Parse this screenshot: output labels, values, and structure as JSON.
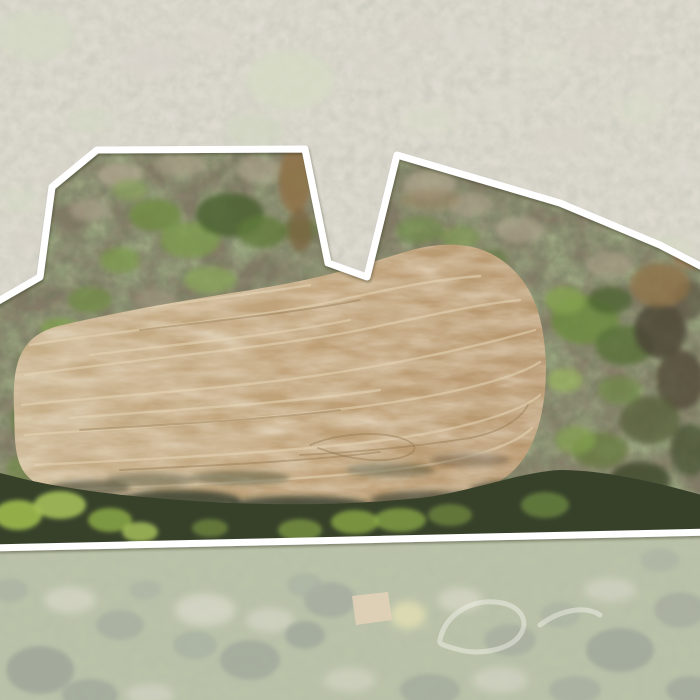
{
  "image": {
    "kind": "aerial-drone-property-photo",
    "description": "Overhead drone photo of a rural parcel outlined with a thick white surveyed boundary. Inside the boundary: leaf-off hardwood forest with scattered green canopy on the upper slope, a large tan tilled crop field with curved cultivation striations in the center, and a dark shadowed tree line along the southern edge. Everything outside the boundary is washed out by a translucent white mask: pale woodland and clearings above, a mowed park-like lawn with scattered trees below."
  },
  "boundary": {
    "stroke_color": "#ffffff",
    "stroke_width": 7,
    "fade_color": "#ffffff",
    "fade_opacity": 0.47,
    "points": "-12,307 40,277 52,187 97,150 305,149 328,263 367,277 397,155 560,203 660,245 712,272 712,532 -12,548"
  },
  "field": {
    "base_color_left": "#c9b28c",
    "base_color_right": "#b6946a",
    "striation_color": "#e6d5b6",
    "track_color": "#93774f",
    "path": "M14,408 C12,360 22,336 58,326 C118,312 185,300 245,291 C288,284 322,277 352,268 C372,262 385,258 405,252 C425,246 440,244 458,245 C478,246 500,254 519,276 C537,297 545,327 546,367 C546,408 537,449 512,472 C483,498 432,503 372,507 C300,513 220,514 152,509 C92,505 42,496 24,472 C13,456 15,430 14,408 Z",
    "striations": [
      "M45,320 C130,308 230,298 310,285",
      "M30,345 C120,330 260,318 340,300 C390,289 430,280 480,276",
      "M25,375 C130,360 250,350 350,332 C420,318 470,305 520,300",
      "M22,405 C120,395 240,388 340,372 C430,358 500,340 535,330",
      "M25,435 C120,428 240,422 350,408 C450,396 515,378 540,362",
      "M35,465 C130,460 250,455 360,443 C460,432 520,412 540,395",
      "M60,490 C160,486 280,482 390,470 C470,461 515,445 532,428",
      "M90,355 C180,344 270,336 350,320",
      "M70,418 C170,410 280,404 380,390"
    ],
    "tracks": [
      "M80,430 C160,425 260,420 340,410",
      "M300,455 C360,452 420,446 470,438 C500,432 520,420 528,405",
      "M310,445 C340,432 390,430 410,442 C425,452 400,462 370,460 C345,458 330,452 318,448",
      "M120,470 C200,466 300,462 380,452",
      "M140,330 C220,320 300,312 360,300"
    ]
  },
  "lawn": {
    "garden_patch_path": "M352,596 L388,592 L392,620 L356,625 Z",
    "garden_patch_color": "#c8a87a",
    "loop_paths": [
      "M440,640 C445,615 470,600 495,602 C520,604 530,620 520,635 C510,650 480,655 460,650 C445,646 438,644 440,640",
      "M540,625 C560,610 585,605 600,615"
    ],
    "loop_color": "#e2e4d4"
  },
  "palette": {
    "woods_base": "#867b68",
    "woods_green": "#7c9a4a",
    "woods_dark_green": "#3c4a2c",
    "bare_crown": "#b3a791",
    "tree_band": "#37412a",
    "band_lime": "#9db94e",
    "creek_brown": "#8f7148",
    "lawn": "#7e8e5c",
    "faded_top": "#c2baa8"
  },
  "scatter": {
    "upper_crowns_light": [
      [
        120,
        175,
        22,
        12,
        "#b3a791",
        0.7
      ],
      [
        180,
        165,
        26,
        12,
        "#aca08a",
        0.6
      ],
      [
        260,
        170,
        24,
        12,
        "#b3a791",
        0.6
      ],
      [
        330,
        190,
        20,
        12,
        "#a89c86",
        0.6
      ],
      [
        430,
        185,
        26,
        14,
        "#b3a791",
        0.65
      ],
      [
        470,
        205,
        22,
        12,
        "#aca08a",
        0.6
      ],
      [
        520,
        230,
        24,
        13,
        "#b3a791",
        0.6
      ],
      [
        610,
        265,
        24,
        13,
        "#a89c86",
        0.6
      ],
      [
        155,
        300,
        20,
        11,
        "#a89c86",
        0.5
      ],
      [
        430,
        270,
        18,
        10,
        "#b3a791",
        0.5
      ],
      [
        90,
        210,
        20,
        11,
        "#b3a791",
        0.55
      ],
      [
        360,
        230,
        18,
        10,
        "#aca08a",
        0.5
      ]
    ],
    "upper_woods_greens": [
      [
        155,
        215,
        26,
        16,
        "#6f8c42",
        0.8
      ],
      [
        190,
        240,
        30,
        18,
        "#7f9e4c",
        0.75
      ],
      [
        230,
        215,
        34,
        22,
        "#4e6333",
        0.85
      ],
      [
        262,
        232,
        24,
        16,
        "#617b3b",
        0.8
      ],
      [
        120,
        260,
        20,
        13,
        "#7c9a4a",
        0.7
      ],
      [
        210,
        280,
        26,
        14,
        "#88a655",
        0.65
      ],
      [
        90,
        300,
        22,
        13,
        "#6f8c42",
        0.7
      ],
      [
        60,
        330,
        20,
        12,
        "#7f9e4c",
        0.75
      ],
      [
        35,
        360,
        16,
        11,
        "#6f8c42",
        0.7
      ],
      [
        300,
        230,
        18,
        12,
        "#5d7539",
        0.6
      ],
      [
        330,
        300,
        22,
        13,
        "#55682f",
        0.8
      ],
      [
        370,
        300,
        20,
        12,
        "#64793b",
        0.7
      ],
      [
        420,
        230,
        24,
        14,
        "#6f8c42",
        0.55
      ],
      [
        460,
        238,
        20,
        12,
        "#7f9e4c",
        0.5
      ],
      [
        300,
        180,
        16,
        10,
        "#87a657",
        0.5
      ],
      [
        130,
        190,
        18,
        11,
        "#87a657",
        0.55
      ],
      [
        490,
        260,
        18,
        11,
        "#64793b",
        0.6
      ],
      [
        25,
        420,
        14,
        18,
        "#617b3b",
        0.65
      ],
      [
        20,
        470,
        14,
        14,
        "#6f8c42",
        0.6
      ]
    ],
    "right_woods": [
      [
        585,
        320,
        34,
        24,
        "#6d8a41",
        0.85
      ],
      [
        625,
        345,
        30,
        20,
        "#59713a",
        0.8
      ],
      [
        565,
        300,
        20,
        14,
        "#86a44f",
        0.8
      ],
      [
        610,
        300,
        22,
        14,
        "#4e6333",
        0.75
      ],
      [
        660,
        330,
        26,
        28,
        "#4a4434",
        0.8
      ],
      [
        680,
        380,
        24,
        30,
        "#514a38",
        0.8
      ],
      [
        650,
        420,
        30,
        24,
        "#55603a",
        0.75
      ],
      [
        600,
        450,
        28,
        18,
        "#64793b",
        0.7
      ],
      [
        575,
        440,
        20,
        14,
        "#86a44f",
        0.65
      ],
      [
        640,
        480,
        30,
        18,
        "#3f4a2c",
        0.8
      ],
      [
        690,
        450,
        20,
        26,
        "#455030",
        0.7
      ],
      [
        565,
        380,
        18,
        12,
        "#9ab558",
        0.6
      ],
      [
        690,
        300,
        16,
        20,
        "#5c5544",
        0.7
      ],
      [
        620,
        390,
        22,
        14,
        "#6d8a41",
        0.6
      ],
      [
        660,
        510,
        30,
        14,
        "#39432a",
        0.8
      ]
    ],
    "creek_patches": [
      [
        295,
        180,
        16,
        34,
        "#8f7148",
        0.85
      ],
      [
        300,
        230,
        12,
        22,
        "#7c633f",
        0.7
      ],
      [
        330,
        290,
        30,
        12,
        "#7c633f",
        0.8
      ],
      [
        660,
        285,
        30,
        22,
        "#8f7148",
        0.75
      ],
      [
        690,
        255,
        18,
        14,
        "#9b7b55",
        0.8
      ],
      [
        385,
        300,
        20,
        10,
        "#7c633f",
        0.6
      ],
      [
        430,
        200,
        30,
        10,
        "#9b8562",
        0.5
      ]
    ],
    "band_shadows": [
      [
        180,
        500,
        60,
        10,
        "#1f2718",
        0.7
      ],
      [
        300,
        505,
        70,
        9,
        "#1f2718",
        0.7
      ],
      [
        430,
        500,
        60,
        9,
        "#232b1a",
        0.6
      ],
      [
        520,
        490,
        50,
        10,
        "#232b1a",
        0.6
      ],
      [
        90,
        488,
        40,
        8,
        "#28301d",
        0.5
      ],
      [
        240,
        478,
        50,
        7,
        "#3a4027",
        0.45
      ],
      [
        390,
        470,
        45,
        7,
        "#3a4027",
        0.4
      ],
      [
        470,
        460,
        40,
        7,
        "#473f2c",
        0.35
      ],
      [
        150,
        480,
        45,
        7,
        "#3a4027",
        0.4
      ]
    ],
    "band_greens": [
      [
        18,
        515,
        24,
        15,
        "#9db94e",
        0.9
      ],
      [
        60,
        505,
        26,
        14,
        "#aac45c",
        0.85
      ],
      [
        110,
        520,
        22,
        12,
        "#8fae48",
        0.8
      ],
      [
        140,
        532,
        18,
        10,
        "#aac45c",
        0.8
      ],
      [
        300,
        530,
        22,
        11,
        "#7e9a44",
        0.75
      ],
      [
        355,
        522,
        24,
        12,
        "#8fae48",
        0.75
      ],
      [
        400,
        520,
        26,
        12,
        "#8fae48",
        0.7
      ],
      [
        450,
        515,
        22,
        11,
        "#7e9a44",
        0.6
      ],
      [
        545,
        505,
        24,
        13,
        "#6f8c42",
        0.7
      ],
      [
        210,
        528,
        18,
        9,
        "#7e9a44",
        0.6
      ]
    ],
    "top_greens": [
      [
        35,
        35,
        40,
        26,
        "#aeb98e",
        0.7
      ],
      [
        290,
        80,
        44,
        30,
        "#b2bd90",
        0.75
      ],
      [
        255,
        130,
        30,
        18,
        "#a8b489",
        0.65
      ],
      [
        665,
        250,
        30,
        16,
        "#b2bd90",
        0.6
      ],
      [
        640,
        110,
        26,
        16,
        "#b9c398",
        0.5
      ],
      [
        90,
        120,
        24,
        14,
        "#b2bd90",
        0.5
      ],
      [
        430,
        120,
        30,
        18,
        "#bac49a",
        0.45
      ],
      [
        545,
        60,
        24,
        14,
        "#c0c9a2",
        0.4
      ],
      [
        20,
        200,
        22,
        14,
        "#b2bd90",
        0.5
      ]
    ],
    "top_crowns": [
      [
        150,
        60,
        30,
        16,
        "#b7ae9c",
        0.6
      ],
      [
        210,
        40,
        26,
        13,
        "#beb5a3",
        0.55
      ],
      [
        370,
        60,
        30,
        15,
        "#b7ae9c",
        0.55
      ],
      [
        470,
        40,
        28,
        14,
        "#beb5a3",
        0.5
      ],
      [
        600,
        40,
        30,
        15,
        "#b7ae9c",
        0.5
      ],
      [
        660,
        80,
        26,
        13,
        "#beb5a3",
        0.5
      ],
      [
        60,
        180,
        26,
        13,
        "#b7ae9c",
        0.5
      ],
      [
        120,
        230,
        24,
        12,
        "#beb5a3",
        0.45
      ],
      [
        30,
        240,
        22,
        12,
        "#b7ae9c",
        0.5
      ],
      [
        560,
        140,
        28,
        14,
        "#b7ae9c",
        0.5
      ],
      [
        680,
        170,
        24,
        12,
        "#beb5a3",
        0.5
      ],
      [
        500,
        100,
        26,
        13,
        "#c2b9a7",
        0.45
      ],
      [
        420,
        30,
        24,
        12,
        "#b7ae9c",
        0.5
      ]
    ],
    "lawn_trees": [
      [
        330,
        600,
        26,
        18,
        "#55624a",
        0.8
      ],
      [
        305,
        585,
        18,
        12,
        "#5f6d52",
        0.7
      ],
      [
        305,
        635,
        20,
        14,
        "#4c5a44",
        0.8
      ],
      [
        250,
        660,
        30,
        20,
        "#4f5d45",
        0.8
      ],
      [
        195,
        645,
        22,
        14,
        "#5a684e",
        0.7
      ],
      [
        120,
        625,
        24,
        15,
        "#55624a",
        0.7
      ],
      [
        40,
        670,
        34,
        24,
        "#4a5741",
        0.85
      ],
      [
        90,
        695,
        28,
        16,
        "#4f5d45",
        0.8
      ],
      [
        510,
        640,
        26,
        16,
        "#55624a",
        0.7
      ],
      [
        560,
        615,
        20,
        13,
        "#5f6d52",
        0.65
      ],
      [
        620,
        650,
        34,
        22,
        "#4a5741",
        0.8
      ],
      [
        680,
        610,
        26,
        18,
        "#55624a",
        0.75
      ],
      [
        660,
        560,
        20,
        12,
        "#5f6d52",
        0.6
      ],
      [
        430,
        690,
        30,
        16,
        "#4f5d45",
        0.7
      ],
      [
        575,
        690,
        26,
        14,
        "#55624a",
        0.7
      ],
      [
        145,
        590,
        16,
        10,
        "#5f6d52",
        0.6
      ],
      [
        690,
        690,
        24,
        14,
        "#4a5741",
        0.7
      ],
      [
        10,
        590,
        18,
        12,
        "#5a684e",
        0.6
      ]
    ],
    "lawn_lights": [
      [
        205,
        610,
        30,
        16,
        "#cfc9b2",
        0.55
      ],
      [
        270,
        620,
        24,
        12,
        "#c8c2ac",
        0.5
      ],
      [
        460,
        600,
        22,
        12,
        "#cfc9b2",
        0.5
      ],
      [
        610,
        590,
        26,
        12,
        "#c8c2ac",
        0.45
      ],
      [
        70,
        600,
        26,
        13,
        "#cfc9b2",
        0.5
      ],
      [
        500,
        680,
        28,
        13,
        "#c8c2ac",
        0.45
      ],
      [
        350,
        680,
        26,
        12,
        "#cfc9b2",
        0.4
      ],
      [
        150,
        695,
        24,
        11,
        "#c8c2ac",
        0.45
      ],
      [
        408,
        615,
        18,
        14,
        "#c5c06f",
        0.85
      ]
    ]
  }
}
